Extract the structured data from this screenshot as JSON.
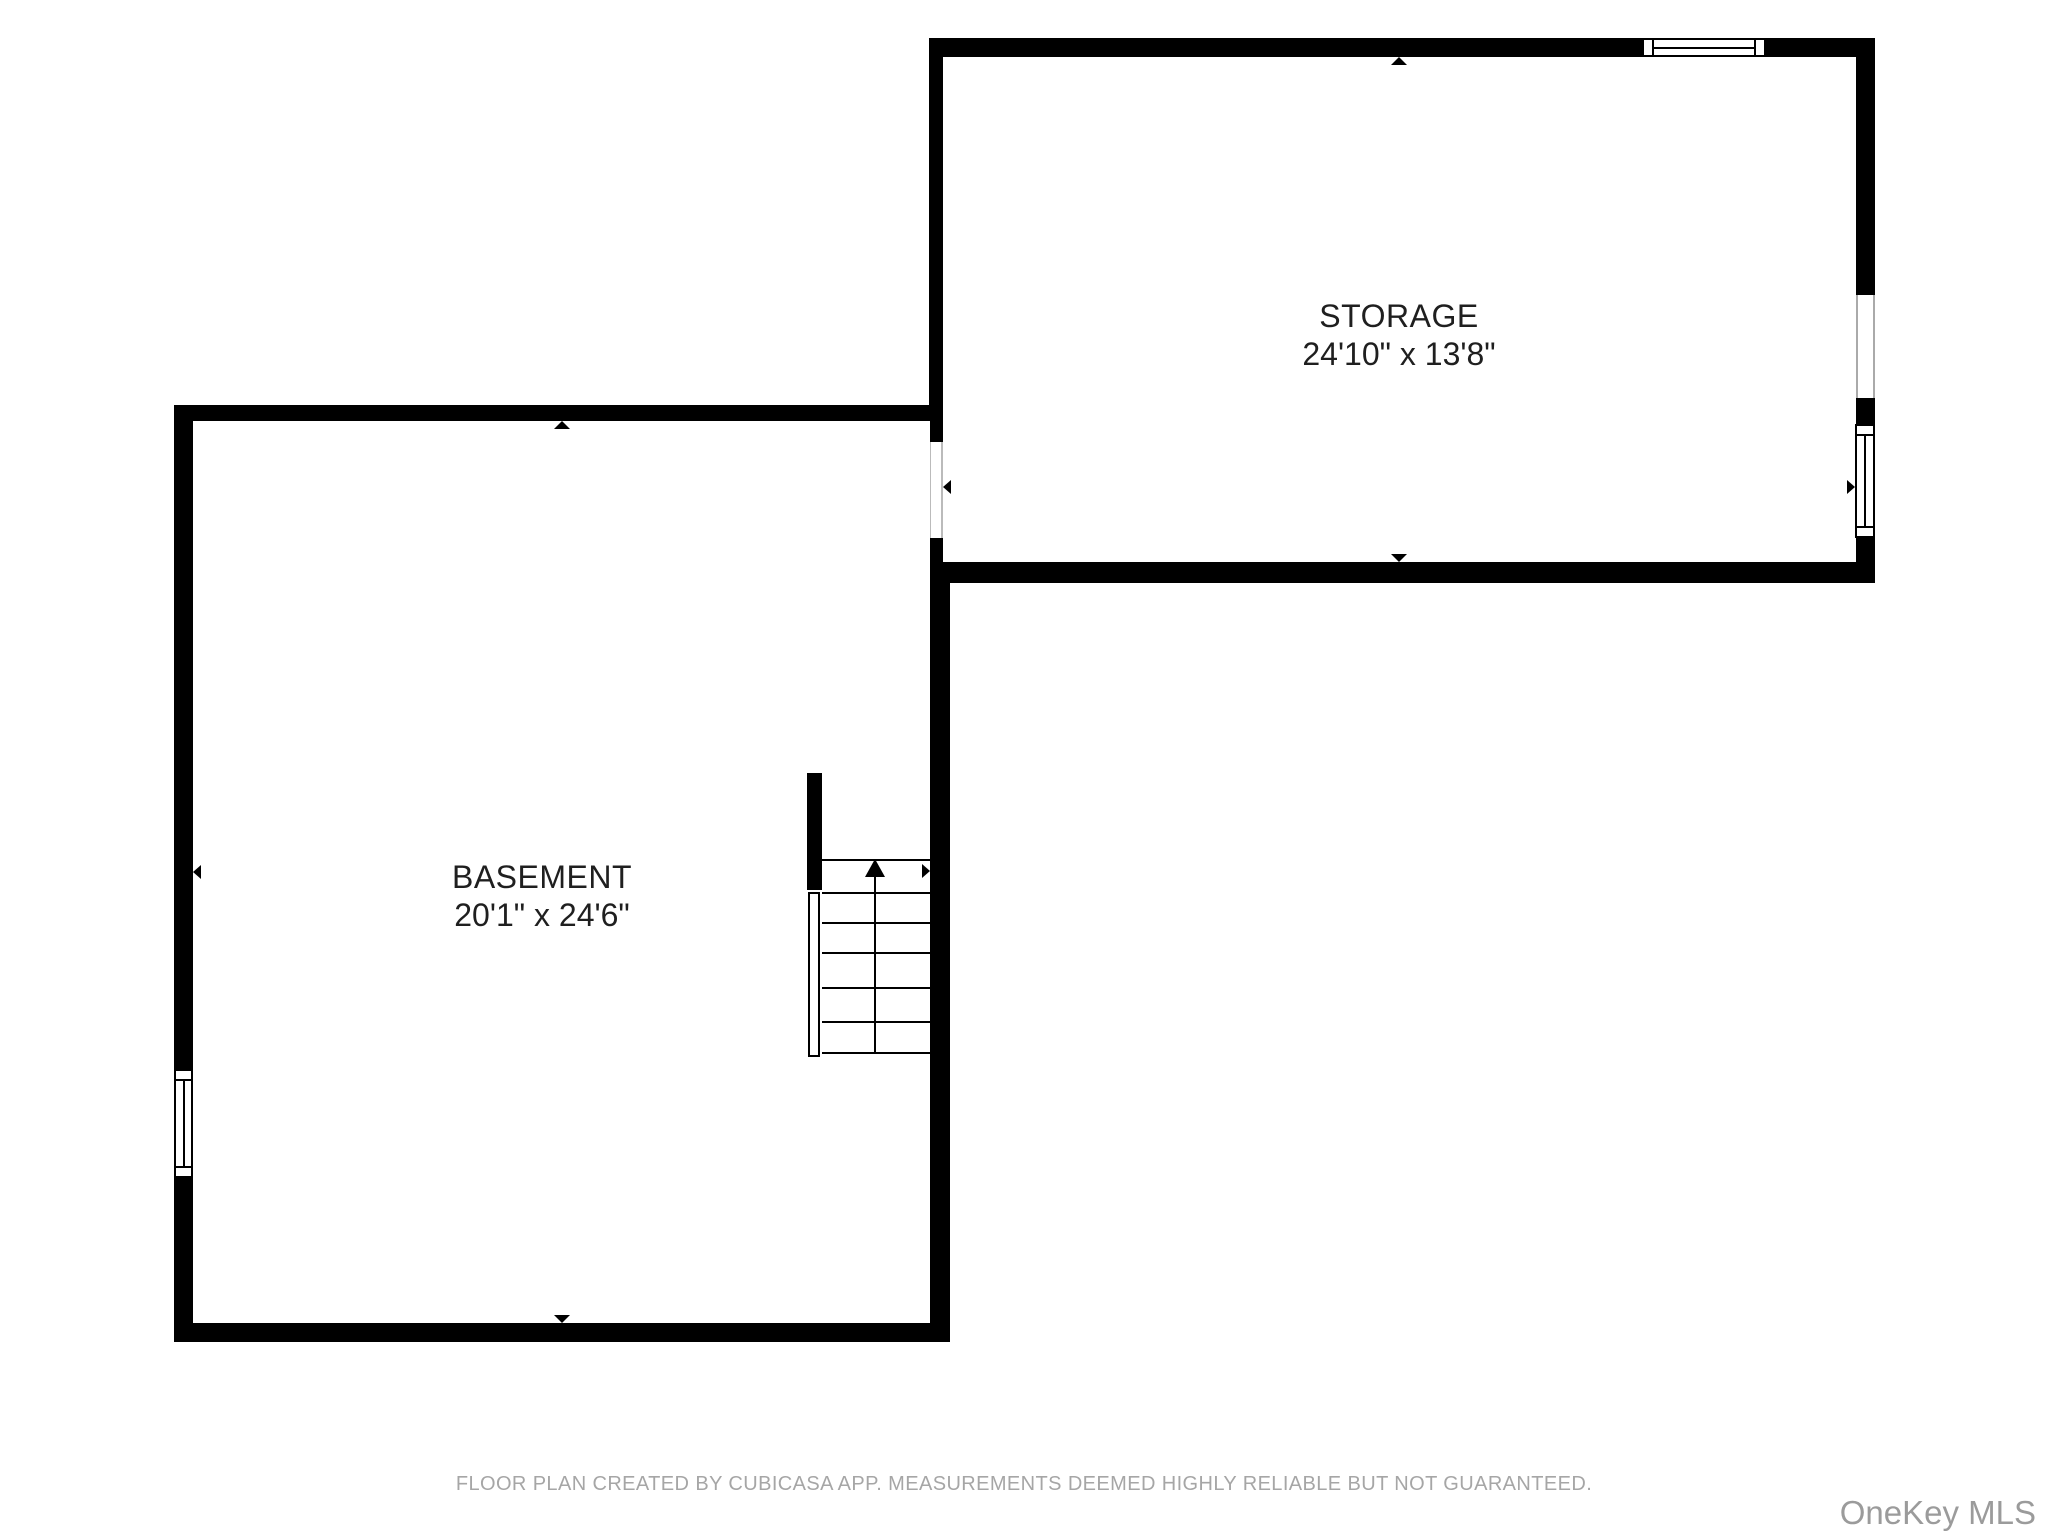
{
  "document": {
    "type": "floor-plan",
    "floor": "basement-level"
  },
  "rooms": {
    "storage": {
      "name": "STORAGE",
      "dims": "24'10\" x 13'8\""
    },
    "basement": {
      "name": "BASEMENT",
      "dims": "20'1\" x 24'6\""
    }
  },
  "footer": {
    "disclaimer": "FLOOR PLAN CREATED BY CUBICASA APP. MEASUREMENTS DEEMED HIGHLY RELIABLE BUT NOT GUARANTEED."
  },
  "watermark": {
    "brand": "OneKey MLS"
  },
  "colors": {
    "background": "#ffffff",
    "wall": "#000000",
    "room_label": "#1f1f1f",
    "disclaimer_text": "#a6a6a6",
    "watermark_text": "#9b9b9b"
  }
}
